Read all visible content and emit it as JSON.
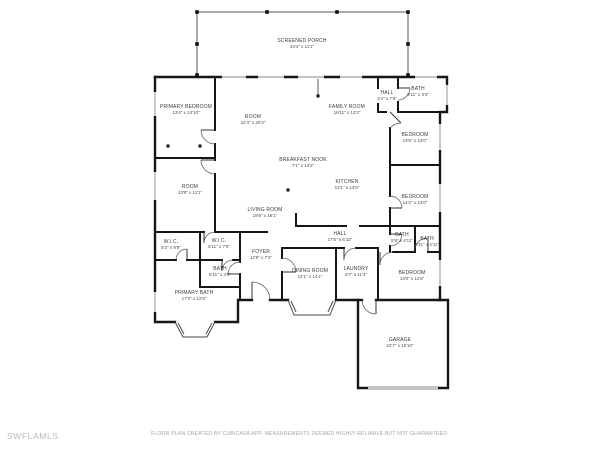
{
  "watermark": "SWFLAMLS",
  "disclaimer": "FLOOR PLAN CREATED BY CUBICASA APP. MEASUREMENTS DEEMED HIGHLY RELIABLE BUT NOT GUARANTEED.",
  "colors": {
    "wall": "#161616",
    "thin_wall": "#5a5a5a",
    "window": "#8a8a8a",
    "label_text": "#3c3c3c",
    "watermark_text": "#b4bac0",
    "disclaimer_text": "#a3a3a3",
    "background": "#ffffff"
  },
  "rooms": [
    {
      "id": "screened-porch",
      "name": "SCREENED PORCH",
      "dims": "44'4\" x 11'1\"",
      "x": 302,
      "y": 44
    },
    {
      "id": "primary-bedroom",
      "name": "PRIMARY BEDROOM",
      "dims": "13'4\" x 14'10\"",
      "x": 186,
      "y": 110
    },
    {
      "id": "room-center",
      "name": "ROOM",
      "dims": "22'4\" x 20'3\"",
      "x": 253,
      "y": 120
    },
    {
      "id": "family-room",
      "name": "FAMILY ROOM",
      "dims": "18'11\" x 13'2\"",
      "x": 347,
      "y": 110
    },
    {
      "id": "hall-top",
      "name": "HALL",
      "dims": "3'4\" x 7'6\"",
      "x": 387,
      "y": 96
    },
    {
      "id": "bath-top",
      "name": "BATH",
      "dims": "9'11\" x 3'4\"",
      "x": 418,
      "y": 92
    },
    {
      "id": "bedroom-right-upper",
      "name": "BEDROOM",
      "dims": "13'6\" x 13'0\"",
      "x": 415,
      "y": 138
    },
    {
      "id": "breakfast-nook",
      "name": "BREAKFAST NOOK",
      "dims": "7'1\" x 13'2\"",
      "x": 303,
      "y": 163
    },
    {
      "id": "kitchen",
      "name": "KITCHEN",
      "dims": "13'1\" x 14'8\"",
      "x": 347,
      "y": 185
    },
    {
      "id": "room-left",
      "name": "ROOM",
      "dims": "13'8\" x 11'1\"",
      "x": 190,
      "y": 190
    },
    {
      "id": "living-room",
      "name": "LIVING ROOM",
      "dims": "19'6\" x 16'1\"",
      "x": 265,
      "y": 213
    },
    {
      "id": "bedroom-right-mid",
      "name": "BEDROOM",
      "dims": "14'2\" x 13'0\"",
      "x": 415,
      "y": 200
    },
    {
      "id": "hall-center",
      "name": "HALL",
      "dims": "17'5\" x 6'10\"",
      "x": 340,
      "y": 237
    },
    {
      "id": "wic-left",
      "name": "W.I.C.",
      "dims": "5'3\" x 9'9\"",
      "x": 171,
      "y": 245
    },
    {
      "id": "wic-center",
      "name": "W.I.C.",
      "dims": "6'11\" x 7'5\"",
      "x": 219,
      "y": 244
    },
    {
      "id": "foyer",
      "name": "FOYER",
      "dims": "12'9\" x 7'4\"",
      "x": 261,
      "y": 255
    },
    {
      "id": "bath-left",
      "name": "BATH",
      "dims": "5'11\" x 4'9\"",
      "x": 220,
      "y": 272
    },
    {
      "id": "bath-right-a",
      "name": "BATH",
      "dims": "5'9\" x 4'11\"",
      "x": 402,
      "y": 238
    },
    {
      "id": "bath-right-b",
      "name": "BATH",
      "dims": "3'11\" x 4'11\"",
      "x": 427,
      "y": 242
    },
    {
      "id": "primary-bath",
      "name": "PRIMARY BATH",
      "dims": "17'2\" x 12'9\"",
      "x": 194,
      "y": 296
    },
    {
      "id": "dining-room",
      "name": "DINING ROOM",
      "dims": "12'1\" x 14'1\"",
      "x": 310,
      "y": 274
    },
    {
      "id": "laundry",
      "name": "LAUNDRY",
      "dims": "6'7\" x 11'4\"",
      "x": 356,
      "y": 272
    },
    {
      "id": "bedroom-right-lower",
      "name": "BEDROOM",
      "dims": "14'0\" x 11'6\"",
      "x": 412,
      "y": 276
    },
    {
      "id": "garage",
      "name": "GARAGE",
      "dims": "22'7\" x 19'10\"",
      "x": 400,
      "y": 343
    }
  ]
}
